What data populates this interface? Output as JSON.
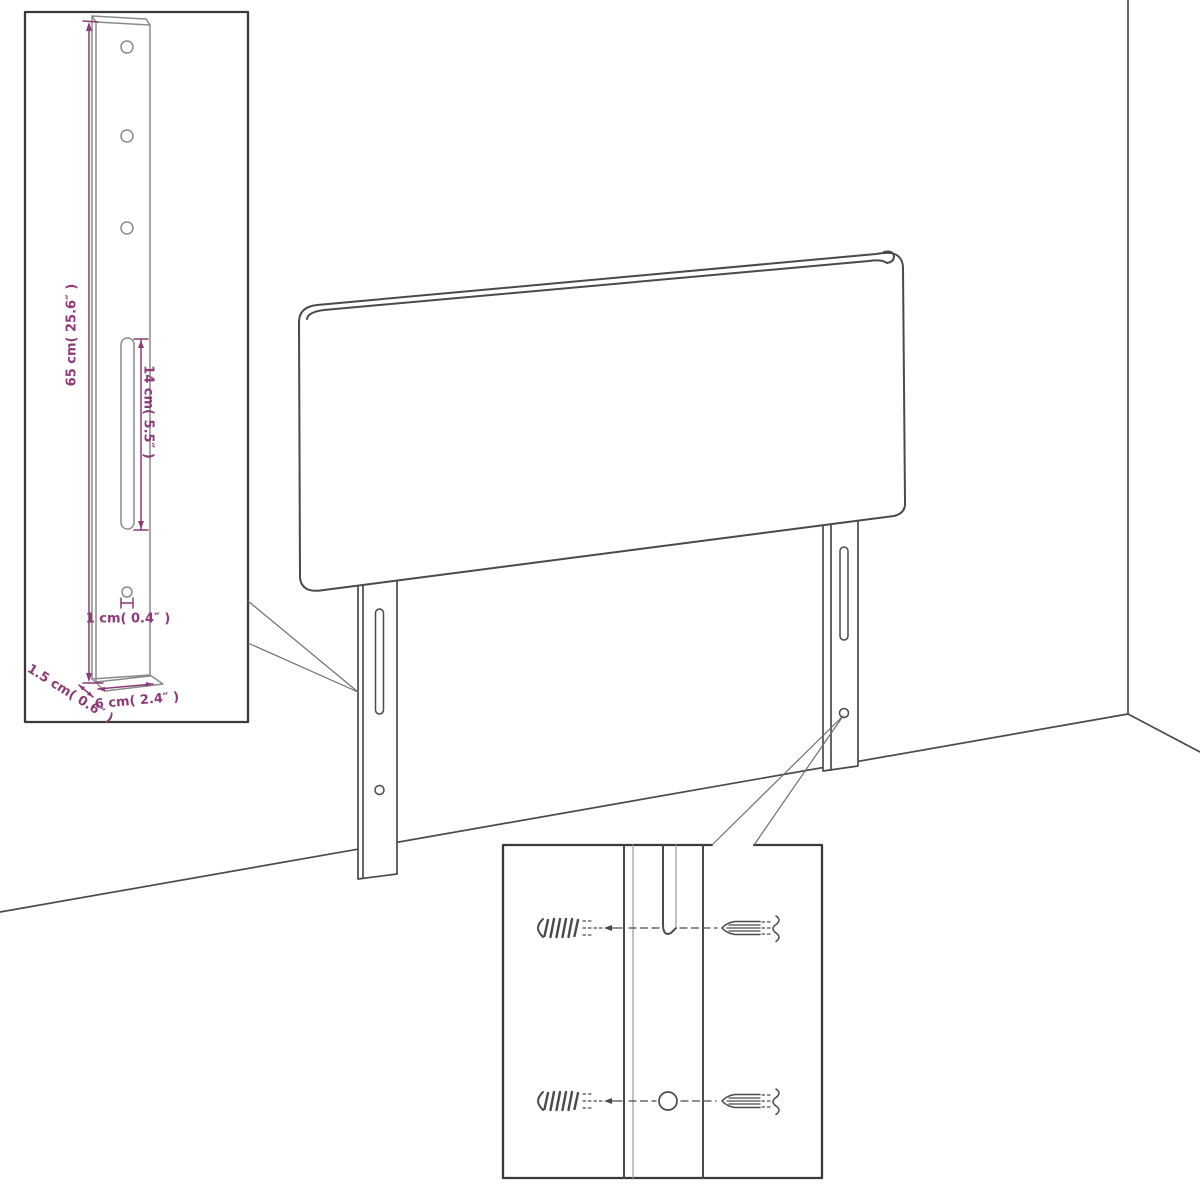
{
  "colors": {
    "background": "#ffffff",
    "line": "#4a4a4a",
    "light_line": "#8a8a8a",
    "border": "#3a3a3a",
    "dimension": "#8c3b78"
  },
  "inset_leg_detail": {
    "labels": {
      "leg_height": "65 cm( 25.6″ )",
      "slot_length": "14 cm( 5.5″ )",
      "hole_diameter": "1 cm( 0.4″ )",
      "leg_thickness": "1.5 cm( 0.6″ )",
      "leg_width": "6 cm( 2.4″ )"
    }
  },
  "inset_mount_detail": {
    "icons": {
      "top_left": "wall-plug-icon",
      "top_right": "screw-icon",
      "bottom_left": "wall-plug-icon",
      "bottom_right": "screw-icon"
    }
  }
}
